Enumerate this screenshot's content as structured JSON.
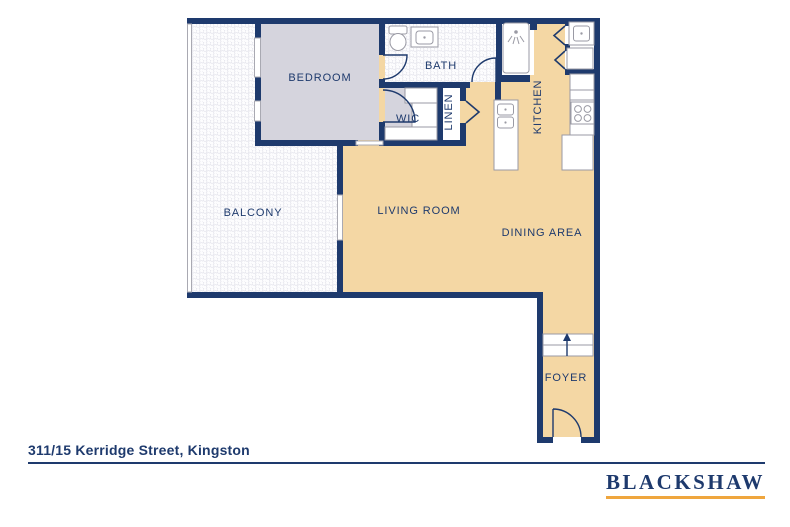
{
  "floorplan": {
    "address": "311/15 Kerridge Street, Kingston",
    "rooms": {
      "bedroom": "BEDROOM",
      "bath": "BATH",
      "wic": "WIC",
      "linen": "LINEN",
      "kitchen": "KITCHEN",
      "balcony": "BALCONY",
      "living": "LIVING ROOM",
      "dining": "DINING AREA",
      "foyer": "FOYER"
    },
    "fixtures": [
      "toilet",
      "vanity-sink",
      "shower",
      "island-double-sink",
      "laundry-sink",
      "washer",
      "stove",
      "fridge",
      "wardrobe-shelves",
      "entry-step-arrow",
      "door-swings",
      "bifold-doors",
      "sliding-doors",
      "balcony-railing"
    ],
    "colors": {
      "wall_navy": "#1e3a6d",
      "floor_tan": "#f4d7a4",
      "bedroom_gray": "#d5d4dd",
      "tile_line": "#e4e4ec",
      "fixture_gray": "#9a9aa4",
      "accent_gold": "#efa63e"
    }
  },
  "branding": {
    "agency": "BLACKSHAW"
  }
}
